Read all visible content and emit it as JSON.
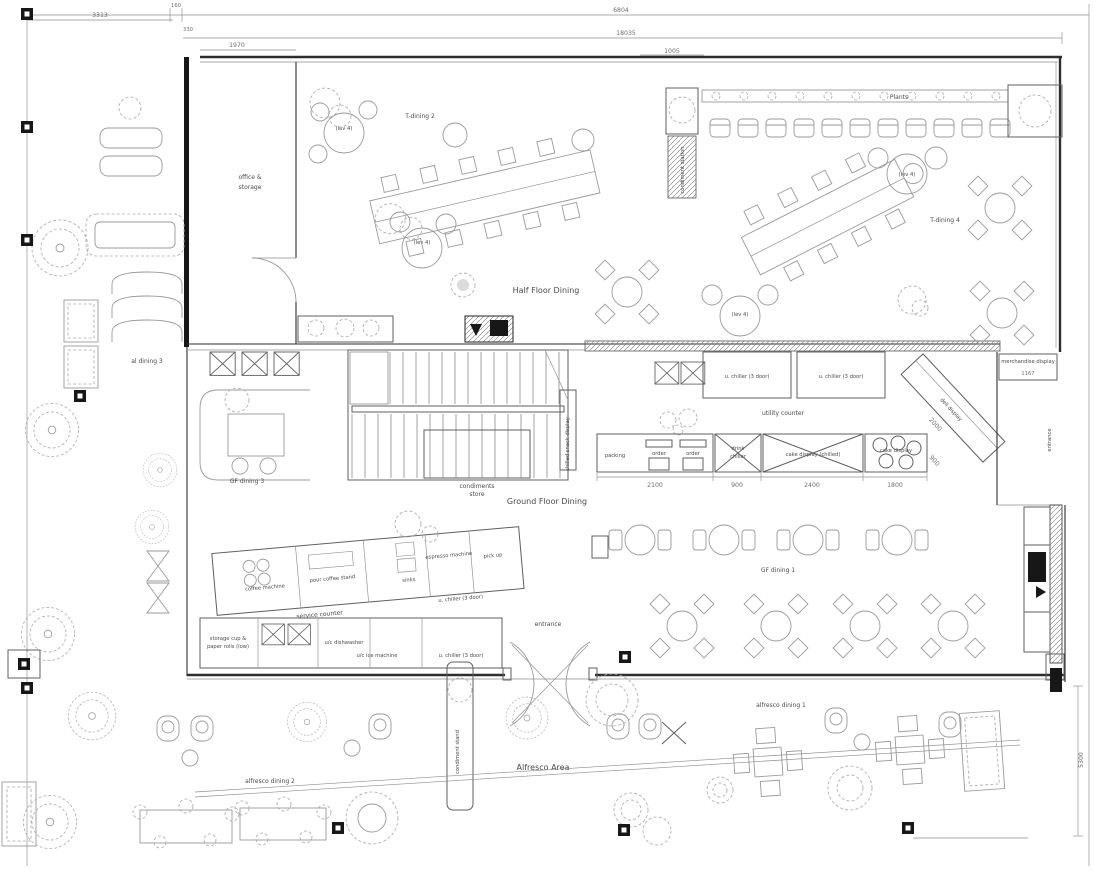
{
  "areas": {
    "plants": "Plants",
    "t_dining_2": "T-dining 2",
    "t_dining_4": "T-dining 4",
    "lev_4": "(lev 4)",
    "half_floor_dining": "Half Floor Dining",
    "ground_floor_dining": "Ground Floor Dining",
    "gf_dining_1": "GF dining 1",
    "gf_dining_3": "GF dining 3",
    "alfresco_area": "Alfresco Area",
    "alfresco_dining_1": "alfresco dining 1",
    "alfresco_dining_2": "alfresco dining 2",
    "al_dining_3": "al dining 3",
    "entrance": "entrance",
    "office_line1": "office &",
    "office_line2": "storage"
  },
  "kitchen": {
    "condiment_station": "condiment station",
    "condiments_store_line1": "condiments",
    "condiments_store_line2": "store",
    "condiment_stand": "condiment stand",
    "utility_counter": "utility counter",
    "u_chiller_3_door": "u. chiller (3 door)",
    "packing": "packing",
    "order": "order",
    "drink_chiller_line1": "drink",
    "drink_chiller_line2": "chiller",
    "cake_display_chilled": "cake display (chilled)",
    "cake_display": "cake display",
    "deli_display": "deli display",
    "merchandise_display": "merchandise display",
    "chilled_snack_display": "chilled snack display",
    "coffee_machine": "coffee machine",
    "pour_coffee_stand": "pour coffee stand",
    "sinks": "sinks",
    "espresso_machine": "espresso machine",
    "pick_up": "pick up",
    "service_counter": "service counter",
    "storage_cups_line1": "storage cup &",
    "storage_cups_line2": "paper rolls (low)",
    "uc_dishwasher": "u/c dishwasher",
    "uc_ice_machine": "u/c ice machine"
  },
  "dimensions": {
    "overall_top": "6804",
    "building_width": "18035",
    "entry_offset": "1005",
    "left_setback": "3313",
    "wall_gap_160": "160",
    "wall_gap_330": "330",
    "office_width": "1970",
    "counter_packing": "2100",
    "counter_drink_chiller": "900",
    "counter_cake_chilled": "2400",
    "counter_cake": "1800",
    "deli_length": "2000",
    "deli_depth": "900",
    "alfresco_depth": "5300",
    "merch_width": "1167"
  },
  "colors": {
    "wall": "#2e2e2e",
    "furniture": "#9a9a9a",
    "label": "#4a4a4a",
    "dim": "#6e6e6e",
    "dark_fill": "#171717",
    "background": "#ffffff"
  }
}
